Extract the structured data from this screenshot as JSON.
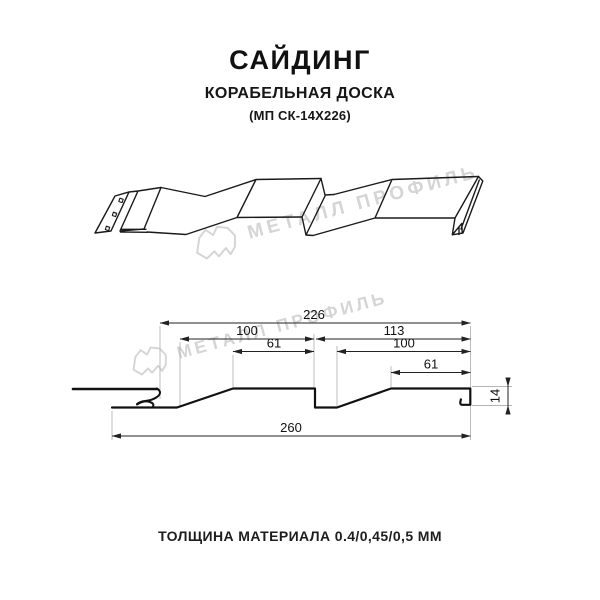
{
  "header": {
    "title": "САЙДИНГ",
    "subtitle": "КОРАБЕЛЬНАЯ ДОСКА",
    "model_code": "(МП СК-14Х226)"
  },
  "watermark": {
    "brand_text": "МЕТАЛЛ ПРОФИЛЬ",
    "color": "#d5d5d5",
    "logo_icon": "metall-profil-logo"
  },
  "dimension_drawing": {
    "dims": {
      "top_width": "226",
      "left_board_width": "100",
      "right_board_width": "113",
      "left_board_top": "61",
      "right_board_inner": "100",
      "right_board_top": "61",
      "bottom_width": "260",
      "profile_height": "14"
    }
  },
  "footer": {
    "thickness_note": "ТОЛЩИНА МАТЕРИАЛА 0.4/0,45/0,5 ММ"
  }
}
